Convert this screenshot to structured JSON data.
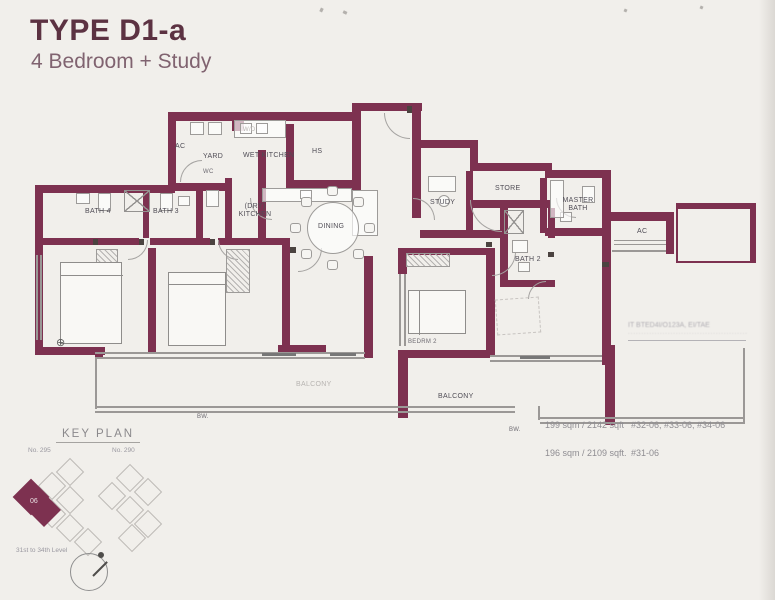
{
  "header": {
    "title": "TYPE D1-a",
    "subtitle": "4 Bedroom + Study"
  },
  "rooms": {
    "ac_left": "AC",
    "yard": "YARD",
    "wet_kitchen": "WET KITCHEN",
    "hs": "HS",
    "wc": "WC",
    "wd": "W/D",
    "bath4": "BATH 4",
    "bath3": "BATH 3",
    "dry_kitchen_line1": "(DRY)",
    "dry_kitchen_line2": "KITCHEN",
    "dining": "DINING",
    "study": "STUDY",
    "store": "STORE",
    "master_bath_line1": "MASTER",
    "master_bath_line2": "BATH",
    "ac_right": "AC",
    "bath2": "BATH 2",
    "bedrm2": "BEDRM 2",
    "balcony_main": "BALCONY",
    "balcony_faint": "BALCONY",
    "bw_mark_1": "BW.",
    "bw_mark_2": "BW."
  },
  "stamp": {
    "line1": "IT BTED4I/O123A, EI/TAE",
    "line2": "·············································"
  },
  "areas": {
    "row1": {
      "size": "199 sqm / 2142 sqft",
      "units": "#32-06, #33-06, #34-06"
    },
    "row2": {
      "size": "196 sqm / 2109 sqft.",
      "units": "#31-06"
    }
  },
  "key_plan": {
    "title": "KEY PLAN",
    "block_left": "No. 295",
    "block_right": "No. 290",
    "unit": "06",
    "levels": "31st to 34th Level"
  }
}
